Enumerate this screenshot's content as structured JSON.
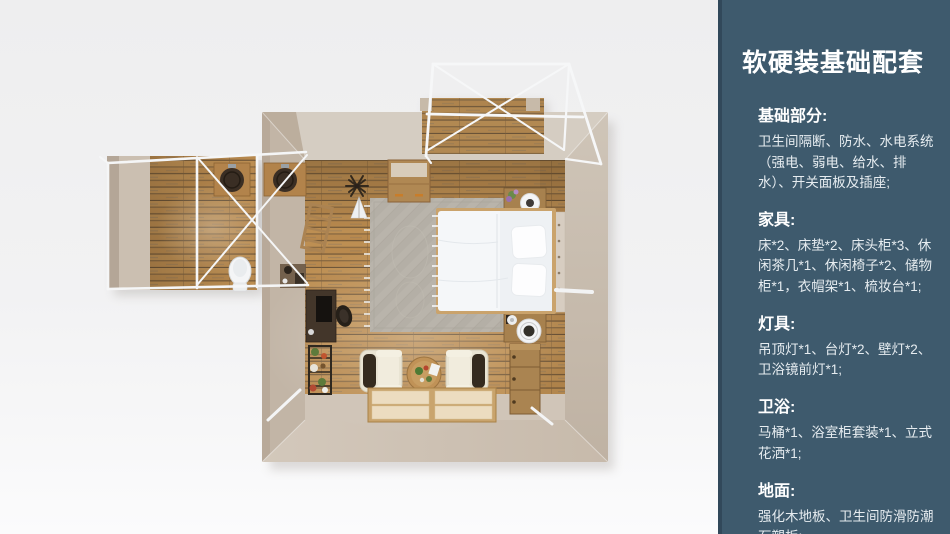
{
  "colors": {
    "sidebar-bg": "#3e5a6d",
    "sidebar-edge": "#31485a",
    "sidebar-heading": "#ffffff",
    "sidebar-body": "#e6ecf0",
    "page-bg-top": "#eeeeef",
    "page-bg-bottom": "#fbfbfc",
    "wall-beige": "#cdc2b5",
    "wall-shadow": "#b7a998",
    "floor-plank": "#b8894e",
    "plank-gap": "#6b5336",
    "frame-white": "#f5f6f7",
    "bed-white": "#f5f7f9",
    "rug-gray": "#b4afa6",
    "wood-furniture": "#a8824f",
    "dark-furniture": "#3a2f26",
    "mat-cream": "#ecdcc0"
  },
  "sidebar": {
    "title": "软硬装基础配套",
    "sections": [
      {
        "heading": "基础部分:",
        "body": "卫生间隔断、防水、水电系统（强电、弱电、给水、排水）、开关面板及插座;"
      },
      {
        "heading": "家具:",
        "body": "床*2、床垫*2、床头柜*3、休闲茶几*1、休闲椅子*2、储物柜*1，衣帽架*1、梳妆台*1;"
      },
      {
        "heading": "灯具:",
        "body": "吊顶灯*1、台灯*2、壁灯*2、卫浴镜前灯*1;"
      },
      {
        "heading": "卫浴:",
        "body": "马桶*1、浴室柜套装*1、立式花洒*1;"
      },
      {
        "heading": "地面:",
        "body": "强化木地板、卫生间防滑防潮石塑板;"
      }
    ]
  },
  "floorplan": {
    "view": "top-down 3D render of a guest-suite room",
    "areas": [
      "bedroom",
      "bathroom-annex",
      "canopy-deck"
    ],
    "items": [
      "canopy-frame",
      "deck-planks",
      "double-sink-counter",
      "toilet",
      "wardrobe-cabinet",
      "coat-rack",
      "area-rug",
      "double-bed",
      "pillows",
      "nightstands",
      "table-lamps",
      "desk",
      "desk-chair",
      "plant-rack",
      "armchairs",
      "round-tea-table",
      "tatami-platform",
      "drawer-chest"
    ]
  }
}
